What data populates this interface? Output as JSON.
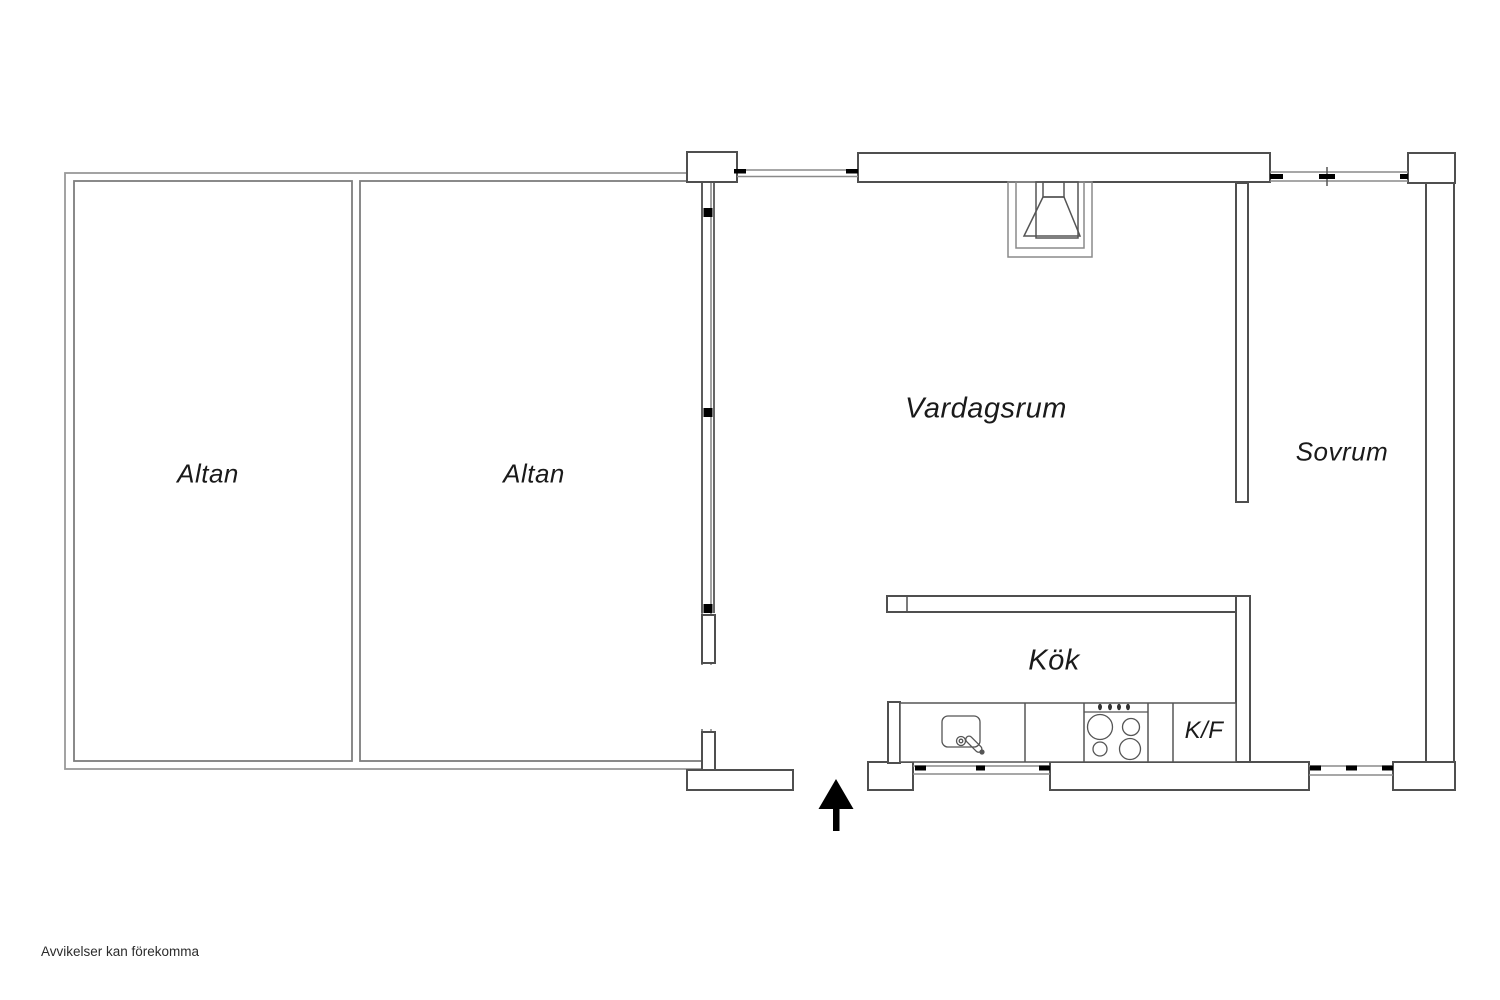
{
  "floor_plan": {
    "rooms": {
      "altan_1": {
        "label": "Altan"
      },
      "altan_2": {
        "label": "Altan"
      },
      "vardagsrum": {
        "label": "Vardagsrum"
      },
      "sovrum": {
        "label": "Sovrum"
      },
      "kok": {
        "label": "Kök"
      },
      "kf": {
        "label": "K/F"
      }
    },
    "disclaimer": "Avvikelser kan förekomma",
    "icons": {
      "north_arrow": "north-arrow",
      "fireplace": "fireplace",
      "sink": "sink",
      "stove": "stove",
      "fridge_freezer_label": "K/F"
    },
    "colors": {
      "background": "#ffffff",
      "wall_outline": "#4f4f4f",
      "thin_wall_line": "#999999",
      "inner_terrace_line": "#7d7d7d",
      "window_line": "#8a8a8a",
      "window_tick": "#000000",
      "fixture_line": "#555555",
      "label_text": "#1a1a1a",
      "north_arrow": "#000000"
    }
  }
}
